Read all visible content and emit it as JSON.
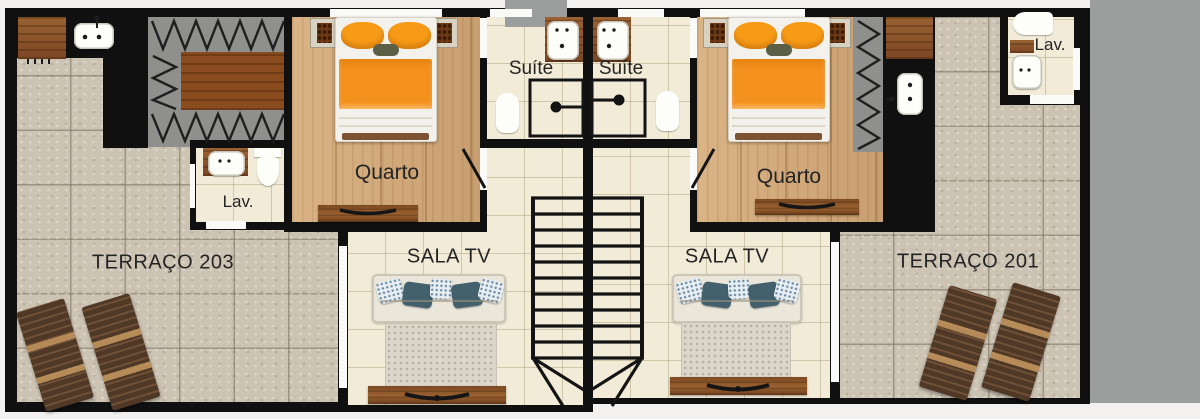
{
  "plan": {
    "type": "residential floor plan, two mirrored duplex units",
    "units": {
      "left": {
        "terrace_label": "TERRAÇO 203",
        "bedroom_label": "Quarto",
        "suite_label": "Suíte",
        "lav_label": "Lav.",
        "tv_room_label": "SALA TV"
      },
      "right": {
        "terrace_label": "TERRAÇO 201",
        "bedroom_label": "Quarto",
        "suite_label": "Suíte",
        "lav_label": "Lav.",
        "tv_room_label": "SALA TV"
      }
    }
  },
  "colors": {
    "wall": "#101010",
    "outside_gray": "#9c9e9d",
    "page_background": "#f2f1ef",
    "terrace_tile": "#ccc3b3",
    "interior_tile": "#f1ebd8",
    "wood_floor": "#cfa87b",
    "bed_orange": "#f5921e",
    "sofa_cream": "#eae6da",
    "pillow_blue": "#43606d",
    "lounge_chair_wood": "#5a4030",
    "label_text": "#242424"
  }
}
